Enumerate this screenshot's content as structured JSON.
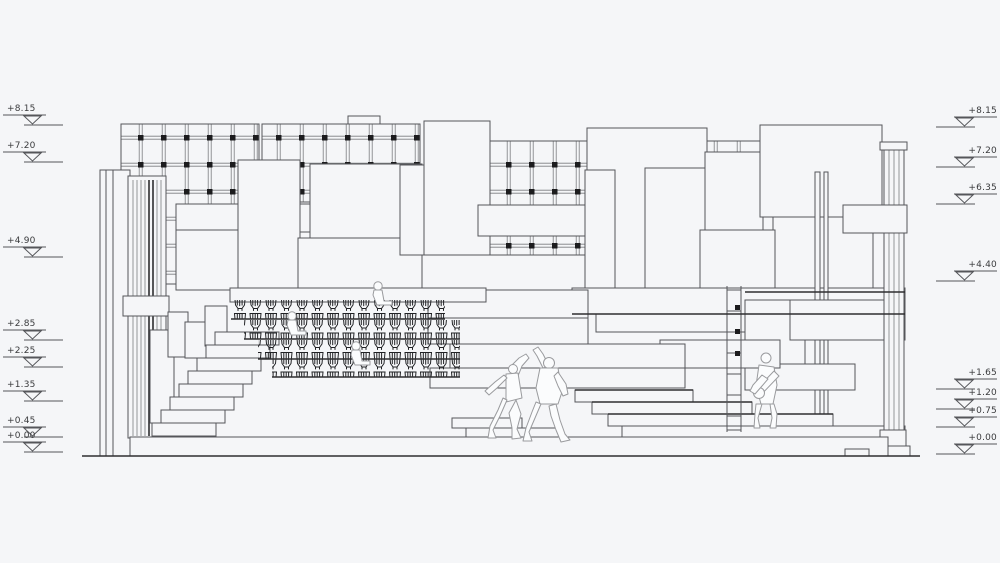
{
  "drawing": {
    "kind": "architectural-section",
    "levels": {
      "left": [
        "+8.15",
        "+7.20",
        "+4.90",
        "+2.85",
        "+2.25",
        "+1.35",
        "+0.45",
        "+0.00"
      ],
      "right": [
        "+8.15",
        "+7.20",
        "+6.35",
        "+4.40",
        "+1.65",
        "+1.20",
        "+0.75",
        "+0.00"
      ]
    },
    "scene": {
      "figures": {
        "seated": 3,
        "dancers": 2,
        "guitarists": 1
      },
      "seat_rows": 4
    },
    "colors": {
      "background": "#f5f6f8",
      "line": "#55565a",
      "dark_line": "#2e2f31",
      "grid_node": "#1c1c1e",
      "figure_fill": "#fbfcfd",
      "figure_line": "#9a9b9e"
    }
  }
}
